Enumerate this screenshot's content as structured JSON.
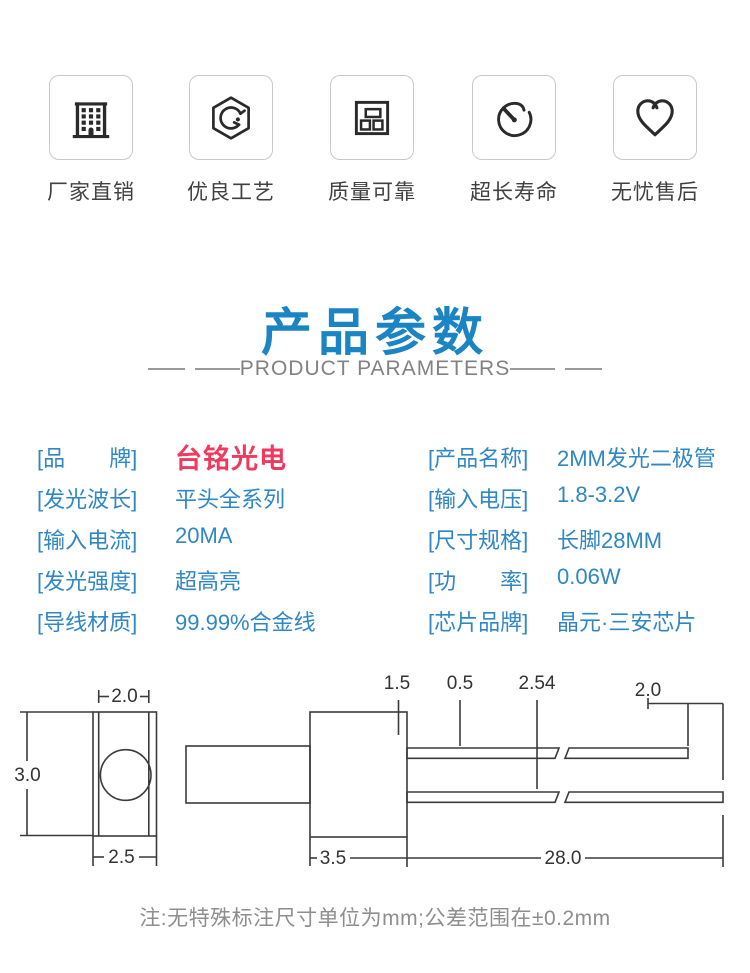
{
  "features": [
    {
      "label": "厂家直销",
      "icon": "building-icon"
    },
    {
      "label": "优良工艺",
      "icon": "craft-badge-icon"
    },
    {
      "label": "质量可靠",
      "icon": "components-icon"
    },
    {
      "label": "超长寿命",
      "icon": "stopwatch-icon"
    },
    {
      "label": "无忧售后",
      "icon": "heart-icon"
    }
  ],
  "section": {
    "title": "产品参数",
    "subtitle": "PRODUCT PARAMETERS"
  },
  "parameters": {
    "left": [
      {
        "label": "[品　　牌]",
        "value": "台铭光电"
      },
      {
        "label": "[发光波长]",
        "value": "平头全系列"
      },
      {
        "label": "[输入电流]",
        "value": "20MA"
      },
      {
        "label": "[发光强度]",
        "value": "超高亮"
      },
      {
        "label": "[导线材质]",
        "value": "99.99%合金线"
      }
    ],
    "right": [
      {
        "label": "[产品名称]",
        "value": "2MM发光二极管"
      },
      {
        "label": "[输入电压]",
        "value": "1.8-3.2V"
      },
      {
        "label": "[尺寸规格]",
        "value": "长脚28MM"
      },
      {
        "label": "[功　　率]",
        "value": "0.06W"
      },
      {
        "label": "[芯片品牌]",
        "value": "晶元·三安芯片"
      }
    ]
  },
  "diagram": {
    "front_view": {
      "top_width": "2.0",
      "height": "3.0",
      "bottom_width": "2.5"
    },
    "side_view": {
      "tip_length": "1.5",
      "lead_thickness": "0.5",
      "lead_pitch": "2.54",
      "lead_end_offset": "2.0",
      "body_length": "3.5",
      "lead_length": "28.0"
    }
  },
  "note": "注:无特殊标注尺寸单位为mm;公差范围在±0.2mm",
  "colors": {
    "title_blue": "#1a85c2",
    "param_blue": "#2f87c4",
    "brand_red": "#f0395c",
    "line_dark": "#3b3b3b",
    "muted_gray": "#8e8e8e"
  }
}
